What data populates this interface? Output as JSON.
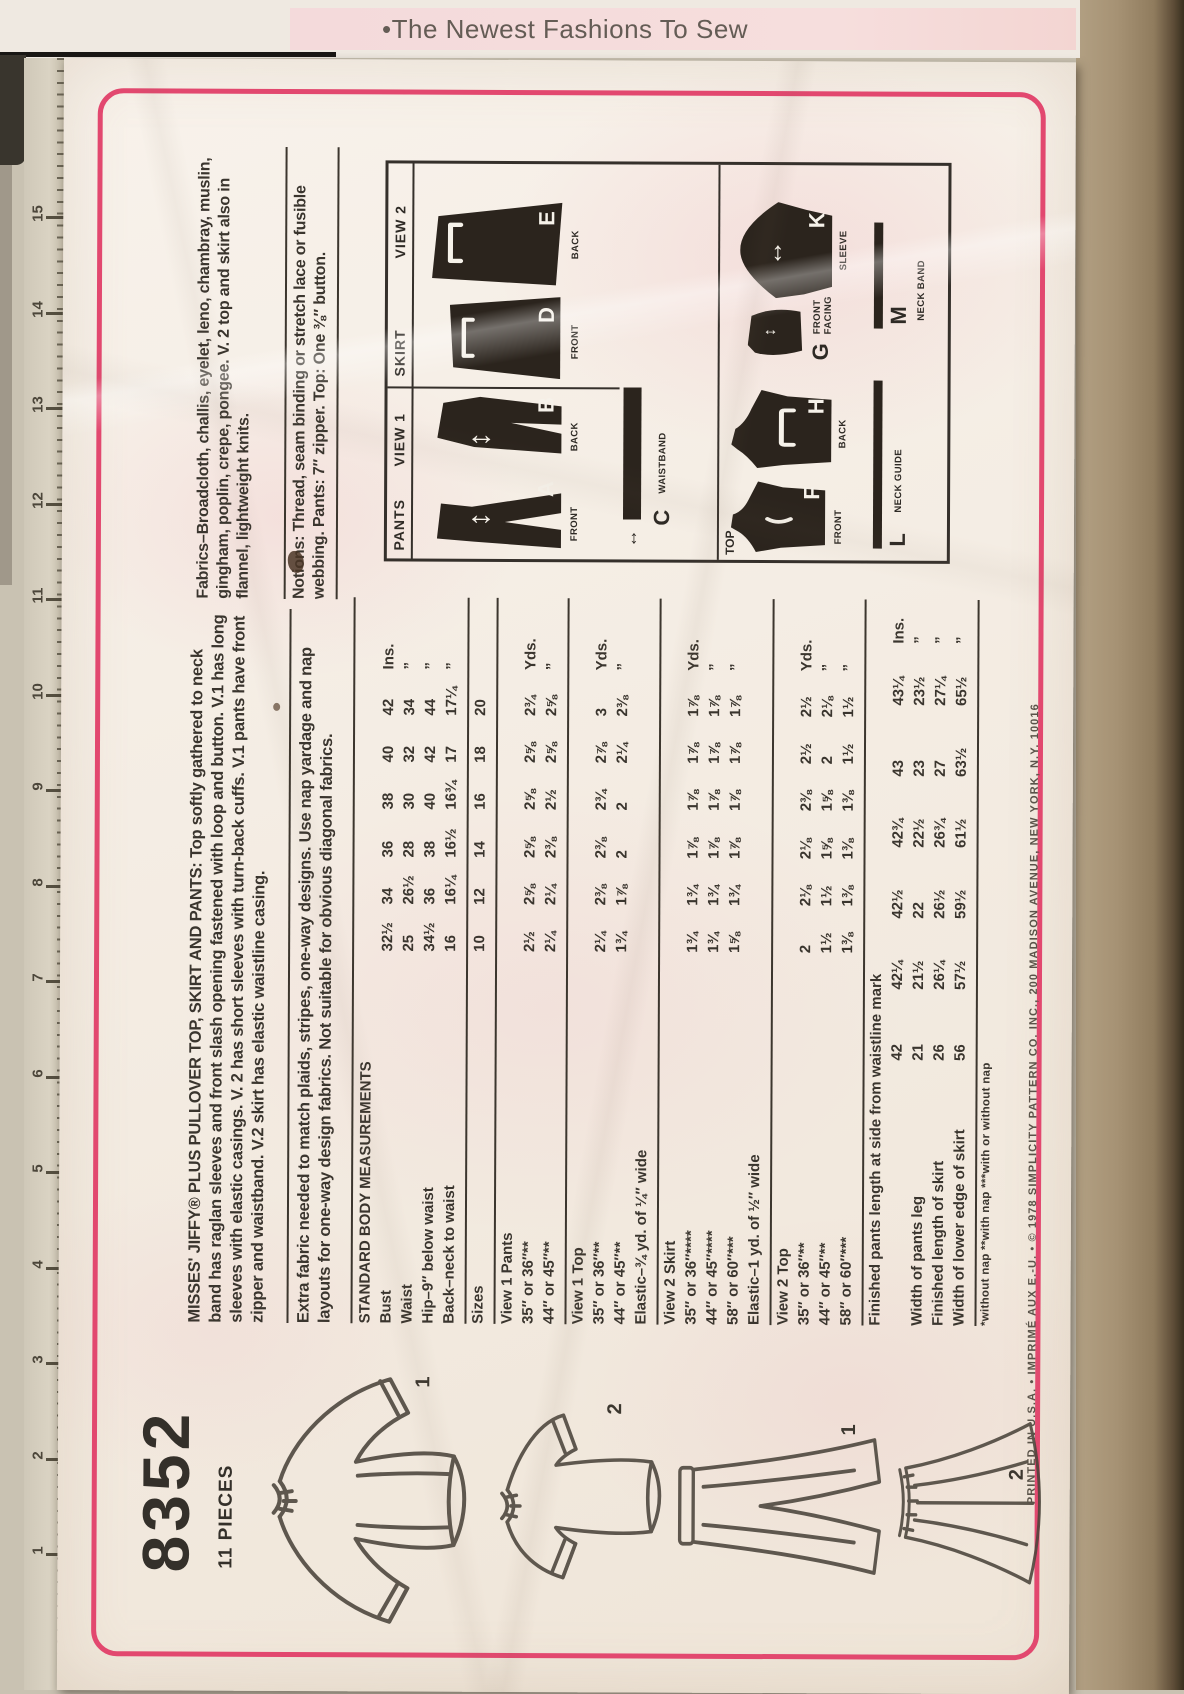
{
  "tagline": "•The Newest Fashions To Sew",
  "envelope": {
    "pattern_number": "8352",
    "pieces_count": "11 PIECES",
    "intro_label": "MISSES' JIFFY® PLUS PULLOVER TOP, SKIRT AND PANTS:",
    "intro_text": " Top softly gathered to neck band has raglan sleeves and front slash opening fastened with loop and button. V.1 has long sleeves with elastic casings. V. 2 has short sleeves with turn-back cuffs. V.1 pants have front zipper and waistband. V.2 skirt has elastic waistline casing.",
    "note_text": "Extra fabric needed to match plaids, stripes, one-way designs. Use nap yardage and nap layouts for one-way design fabrics. Not suitable for obvious diagonal fabrics.",
    "fabrics_label": "Fabrics",
    "fabrics_text": "–Broadcloth, challis, eyelet, leno, chambray, muslin, gingham, poplin, crepe, pongee. V. 2 top and skirt also in flannel, lightweight knits.",
    "notions_label": "Notions:",
    "notions_text": " Thread, seam binding or stretch lace or fusible webbing. Pants: 7″ zipper. Top: One ⅜″ button.",
    "fine_print": "PRINTED IN U.S.A.  •  IMPRIMÉ AUX E.-U.  •  © 1978 SIMPLICITY PATTERN CO. INC., 200 MADISON AVENUE, NEW YORK, N.Y. 10016"
  },
  "sketches": {
    "numbers": [
      "1",
      "2",
      "1",
      "2"
    ]
  },
  "ruler": {
    "numbers": [
      "15",
      "14",
      "13",
      "12",
      "11",
      "10",
      "9",
      "8",
      "7",
      "6",
      "5",
      "4",
      "3",
      "2",
      "1"
    ]
  },
  "diagram": {
    "pants_label": "PANTS",
    "view1_label": "VIEW 1",
    "skirt_label": "SKIRT",
    "view2_label": "VIEW 2",
    "top_label": "TOP",
    "pieces": [
      {
        "letter": "A",
        "label": "FRONT"
      },
      {
        "letter": "B",
        "label": "BACK"
      },
      {
        "letter": "D",
        "label": "FRONT"
      },
      {
        "letter": "E",
        "label": "BACK"
      },
      {
        "letter": "F",
        "label": "FRONT"
      },
      {
        "letter": "H",
        "label": "BACK"
      },
      {
        "letter": "G",
        "label": "FRONT\nFACING"
      },
      {
        "letter": "K",
        "label": "SLEEVE"
      }
    ],
    "bars": [
      {
        "letter": "C",
        "label": "WAISTBAND"
      },
      {
        "letter": "L",
        "label": "NECK GUIDE"
      },
      {
        "letter": "M",
        "label": "NECK BAND"
      }
    ]
  },
  "table": {
    "heading": "STANDARD BODY MEASUREMENTS",
    "body_rows": [
      {
        "label": "Bust",
        "values": [
          "32½",
          "34",
          "36",
          "38",
          "40",
          "42"
        ],
        "unit": "Ins."
      },
      {
        "label": "Waist",
        "values": [
          "25",
          "26½",
          "28",
          "30",
          "32",
          "34"
        ],
        "unit": "”"
      },
      {
        "label": "Hip–9″ below waist",
        "values": [
          "34½",
          "36",
          "38",
          "40",
          "42",
          "44"
        ],
        "unit": "”"
      },
      {
        "label": "Back–neck to waist",
        "values": [
          "16",
          "16¼",
          "16½",
          "16¾",
          "17",
          "17¼"
        ],
        "unit": "”"
      }
    ],
    "sizes_row": {
      "label": "Sizes",
      "values": [
        "10",
        "12",
        "14",
        "16",
        "18",
        "20"
      ],
      "unit": ""
    },
    "sections": [
      {
        "heading": "View 1 Pants",
        "rows": [
          {
            "label": "35″ or 36″**",
            "values": [
              "2½",
              "2⅝",
              "2⅝",
              "2⅝",
              "2⅝",
              "2¾"
            ],
            "unit": "Yds."
          },
          {
            "label": "44″ or 45″**",
            "values": [
              "2¼",
              "2¼",
              "2⅜",
              "2½",
              "2⅝",
              "2⅝"
            ],
            "unit": "”"
          }
        ]
      },
      {
        "heading": "View 1 Top",
        "rows": [
          {
            "label": "35″ or 36″**",
            "values": [
              "2¼",
              "2⅜",
              "2⅜",
              "2¾",
              "2⅞",
              "3"
            ],
            "unit": "Yds."
          },
          {
            "label": "44″ or 45″**",
            "values": [
              "1¾",
              "1⅞",
              "2",
              "2",
              "2¼",
              "2⅜"
            ],
            "unit": "”"
          },
          {
            "label": "Elastic–¾ yd. of ¼″ wide",
            "values": [],
            "unit": ""
          }
        ]
      },
      {
        "heading": "View 2 Skirt",
        "rows": [
          {
            "label": "35″ or 36″****",
            "values": [
              "1¾",
              "1¾",
              "1⅞",
              "1⅞",
              "1⅞",
              "1⅞"
            ],
            "unit": "Yds."
          },
          {
            "label": "44″ or 45″****",
            "values": [
              "1¾",
              "1¾",
              "1⅞",
              "1⅞",
              "1⅞",
              "1⅞"
            ],
            "unit": "”"
          },
          {
            "label": "58″ or 60″***",
            "values": [
              "1⅝",
              "1¾",
              "1⅞",
              "1⅞",
              "1⅞",
              "1⅞"
            ],
            "unit": "”"
          },
          {
            "label": "Elastic–1 yd. of ½″ wide",
            "values": [],
            "unit": ""
          }
        ]
      },
      {
        "heading": "View 2 Top",
        "rows": [
          {
            "label": "35″ or 36″**",
            "values": [
              "2",
              "2⅛",
              "2⅛",
              "2⅜",
              "2½",
              "2½"
            ],
            "unit": "Yds."
          },
          {
            "label": "44″ or 45″**",
            "values": [
              "1½",
              "1½",
              "1⅝",
              "1⅝",
              "2",
              "2⅛"
            ],
            "unit": "”"
          },
          {
            "label": "58″ or 60″***",
            "values": [
              "1⅜",
              "1⅜",
              "1⅜",
              "1⅜",
              "1½",
              "1½"
            ],
            "unit": "”"
          }
        ]
      },
      {
        "heading": "Finished pants length at side from waistline mark",
        "wide": true,
        "rows": [
          {
            "label": "",
            "values": [
              "42",
              "42¼",
              "42½",
              "42¾",
              "43",
              "43¼"
            ],
            "unit": "Ins."
          },
          {
            "label": "Width of pants leg",
            "values": [
              "21",
              "21½",
              "22",
              "22½",
              "23",
              "23½"
            ],
            "unit": "”"
          },
          {
            "label": "Finished length of skirt",
            "values": [
              "26",
              "26¼",
              "26½",
              "26¾",
              "27",
              "27¼"
            ],
            "unit": "”"
          },
          {
            "label": "Width of lower edge of skirt",
            "values": [
              "56",
              "57½",
              "59½",
              "61½",
              "63½",
              "65½"
            ],
            "unit": "”"
          }
        ]
      }
    ],
    "footnote": "*without nap      **with nap      ***with or without nap"
  }
}
